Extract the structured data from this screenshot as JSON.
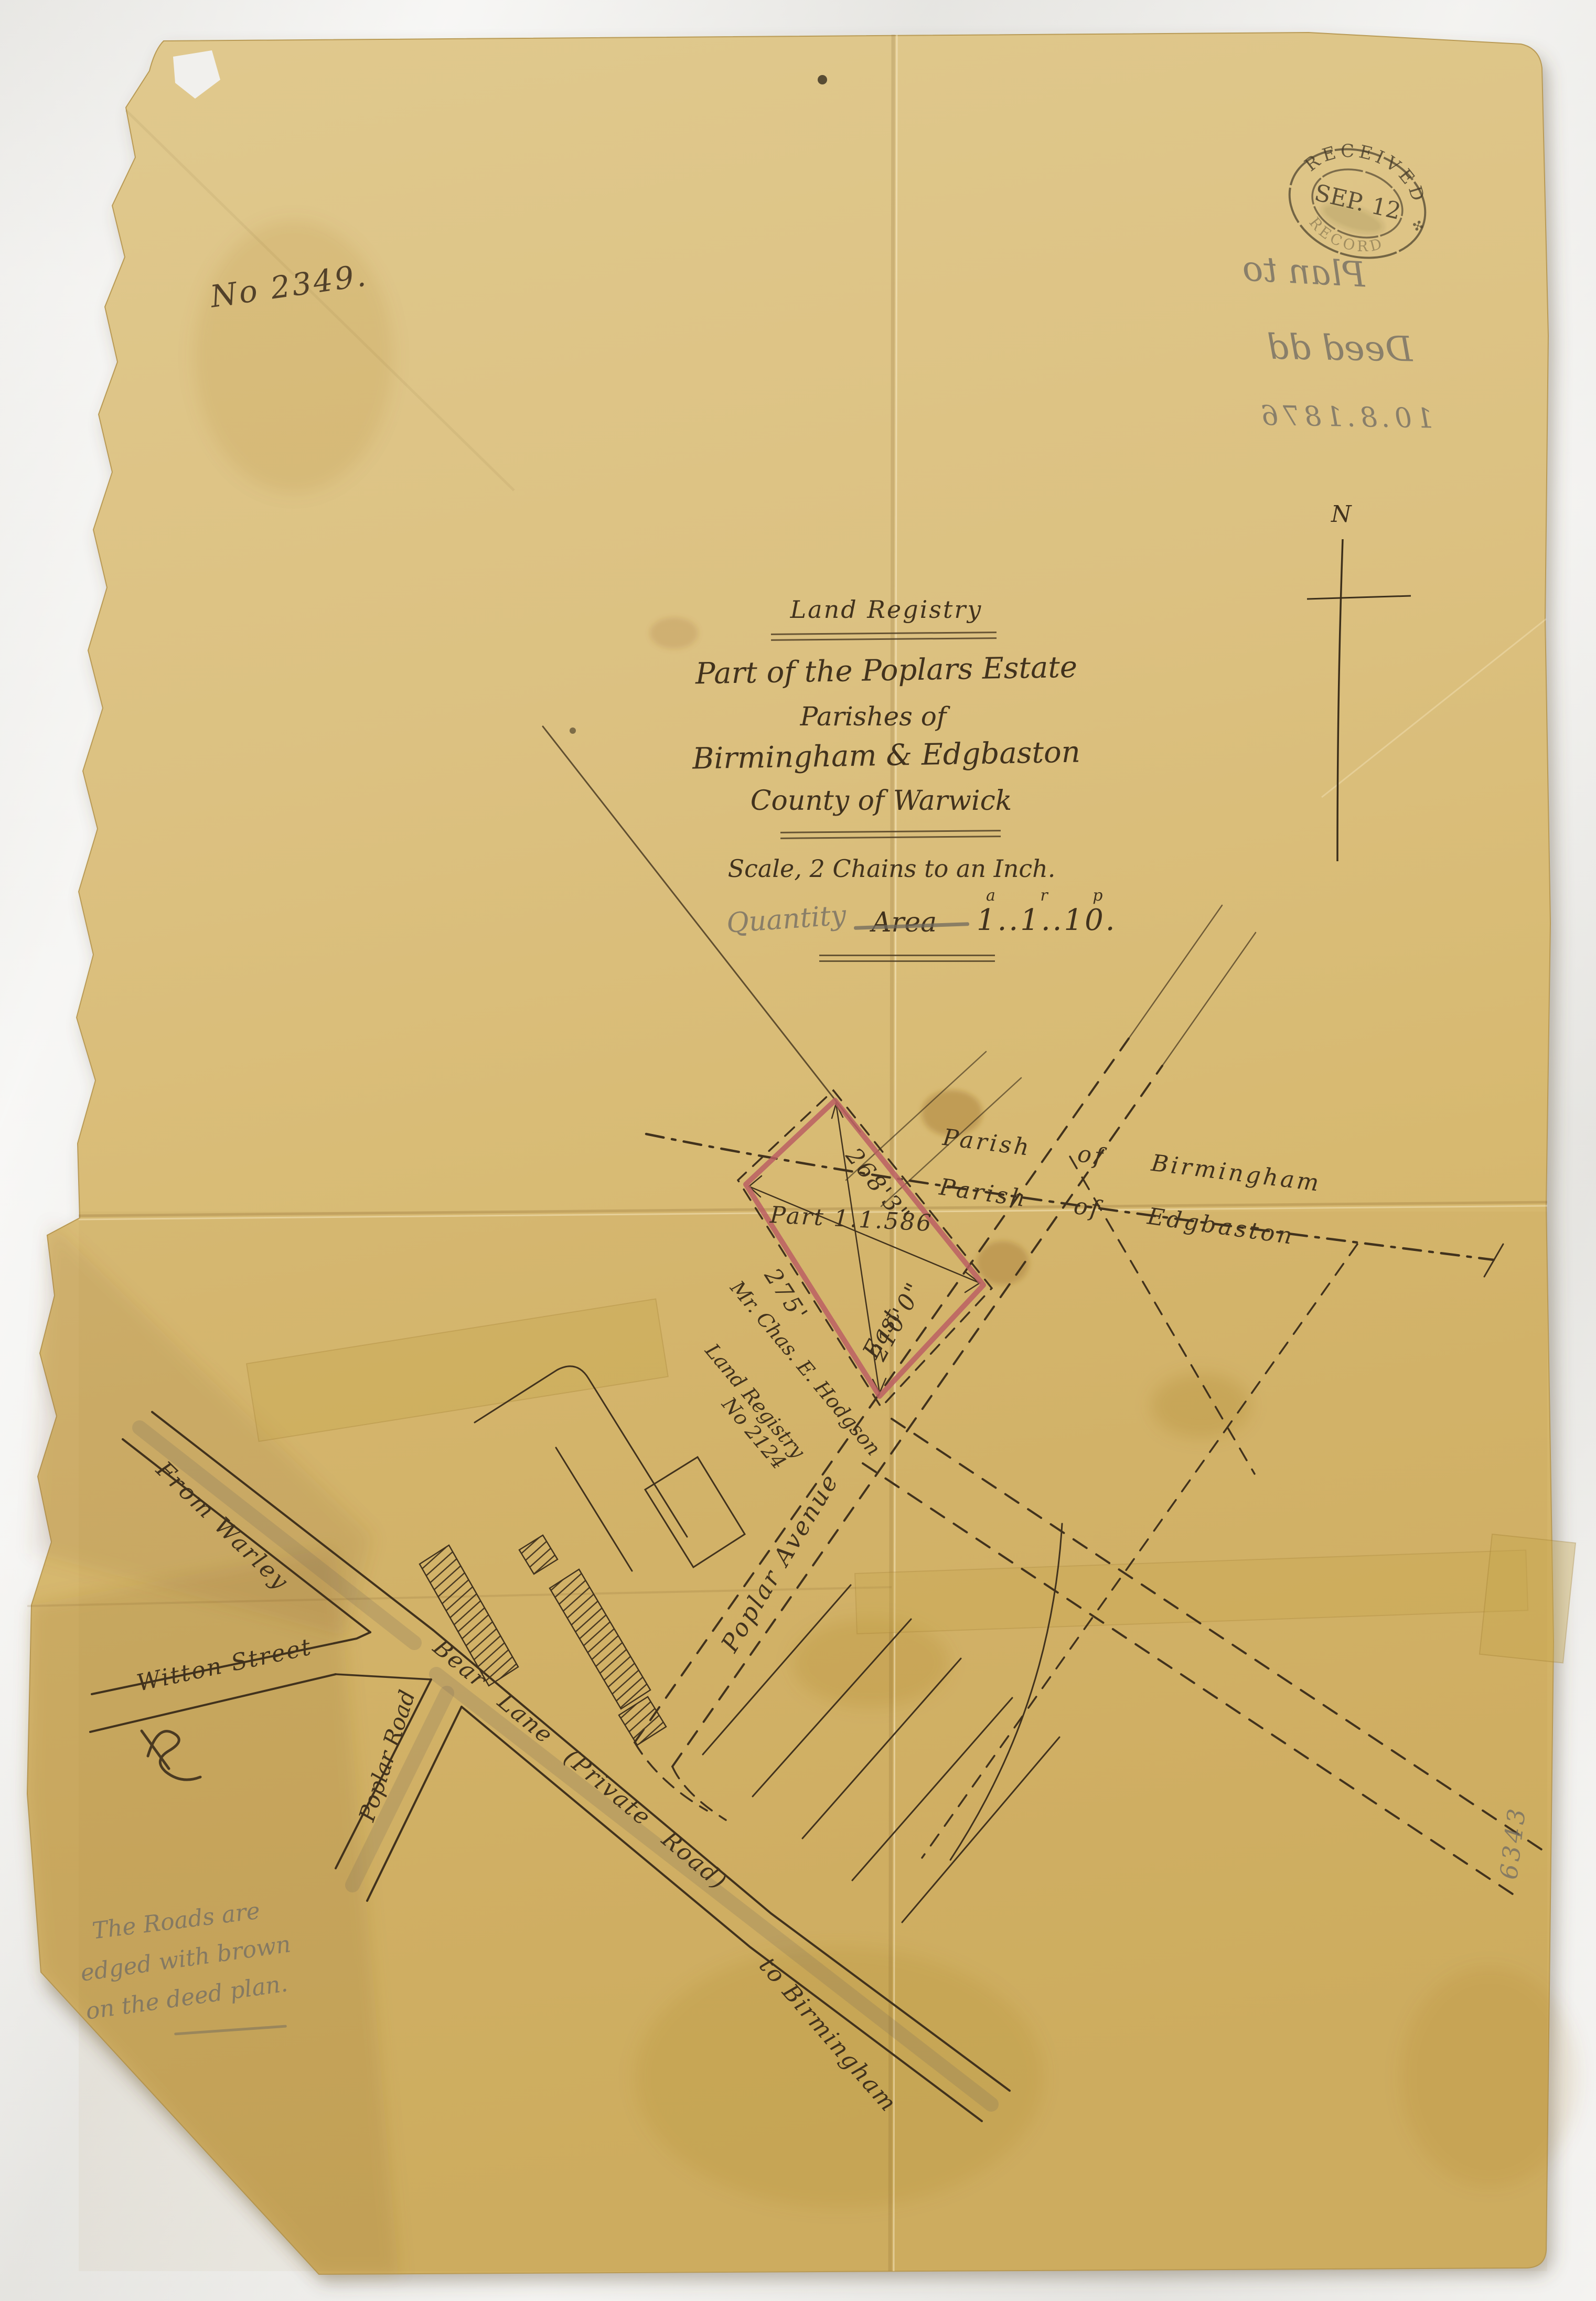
{
  "document": {
    "ref_number": "No 2349.",
    "stamp": {
      "top_arc": "RECEIVED",
      "date_line": "SEP. 12",
      "bottom_arc": "RECORD",
      "ornament": "✣"
    },
    "pencil_annotation": {
      "line1": "Plan to",
      "line2": "Deed dd",
      "line3": "10.8.1876"
    },
    "title_block": {
      "heading": "Land Registry",
      "estate_line": "Part of the Poplars Estate",
      "parishes_line": "Parishes of",
      "parish_names": "Birmingham & Edgbaston",
      "county_line": "County of Warwick",
      "scale_line": "Scale, 2 Chains to an Inch.",
      "quantity_label": "Quantity",
      "area_label": "Area",
      "arp_superscript": "a r p",
      "area_value": "1..1..10."
    },
    "north_label": "N",
    "map": {
      "parish_upper": "Parish of Birmingham",
      "parish_lower": "Parish of Edgbaston",
      "parcel_label": "Part 1.1.586",
      "dim_northeast": "268'3\"",
      "dim_southwest": "275'",
      "dim_southeast": "210'0\"",
      "owner_line1": "Mr. Chas. E. Hodgson",
      "owner_line2": "Land Registry",
      "owner_line3": "No 2124",
      "road_from_warley": "From Warley",
      "road_witton": "Witton Street",
      "road_poplar_road": "Poplar Road",
      "road_bear_lane": "Bear Lane (Private Road)",
      "road_poplar_avenue": "Poplar Avenue",
      "road_east": "East",
      "road_to_birmingham": "to Birmingham"
    },
    "pencil_note": {
      "line1": "The Roads are",
      "line2": "edged with brown",
      "line3": "on the deed plan."
    },
    "margin_number": "6343",
    "colors": {
      "paper": "#d9bd77",
      "ink": "#41321d",
      "red_edging": "#bb5f63",
      "pencil": "#756f64"
    }
  }
}
